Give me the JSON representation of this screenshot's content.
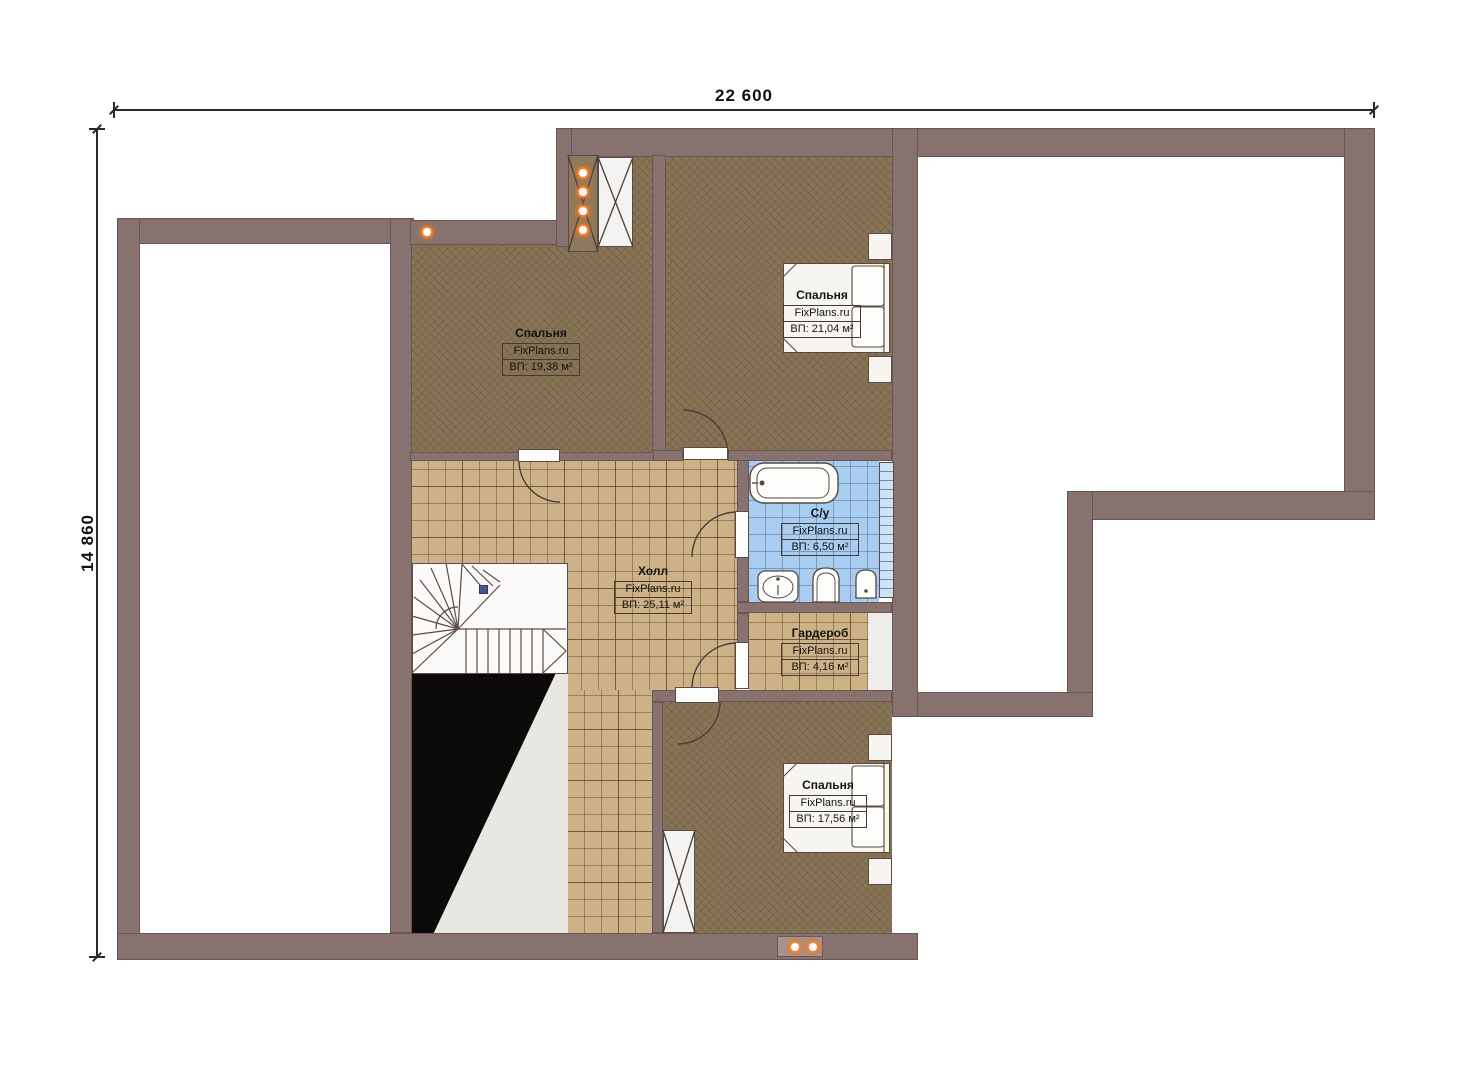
{
  "dimensions": {
    "width_label": "22 600",
    "height_label": "14 860"
  },
  "brand": "FixPlans.ru",
  "rooms": [
    {
      "id": "bedroom-1",
      "name": "Спальня",
      "brand": "FixPlans.ru",
      "area": "ВП: 19,38 м²"
    },
    {
      "id": "bedroom-2",
      "name": "Спальня",
      "brand": "FixPlans.ru",
      "area": "ВП: 21,04 м²"
    },
    {
      "id": "bathroom",
      "name": "С/у",
      "brand": "FixPlans.ru",
      "area": "ВП: 6,50 м²"
    },
    {
      "id": "hall",
      "name": "Холл",
      "brand": "FixPlans.ru",
      "area": "ВП: 25,11 м²"
    },
    {
      "id": "wardrobe",
      "name": "Гардероб",
      "brand": "FixPlans.ru",
      "area": "ВП: 4,16 м²"
    },
    {
      "id": "bedroom-3",
      "name": "Спальня",
      "brand": "FixPlans.ru",
      "area": "ВП: 17,56 м²"
    }
  ],
  "fixtures": [
    "bathtub",
    "sink",
    "toilet",
    "bidet",
    "bed",
    "nightstand",
    "staircase",
    "chimney",
    "ventilation-shaft",
    "spotlight",
    "window"
  ],
  "colors": {
    "wall": "#87726f",
    "carpet": "#877355",
    "hall_tile": "#cdb287",
    "bath_tile": "#a9cdf0",
    "window_glass": "#cfe2f5",
    "spotlight": "#ef8532",
    "void": "#0b0a09"
  }
}
